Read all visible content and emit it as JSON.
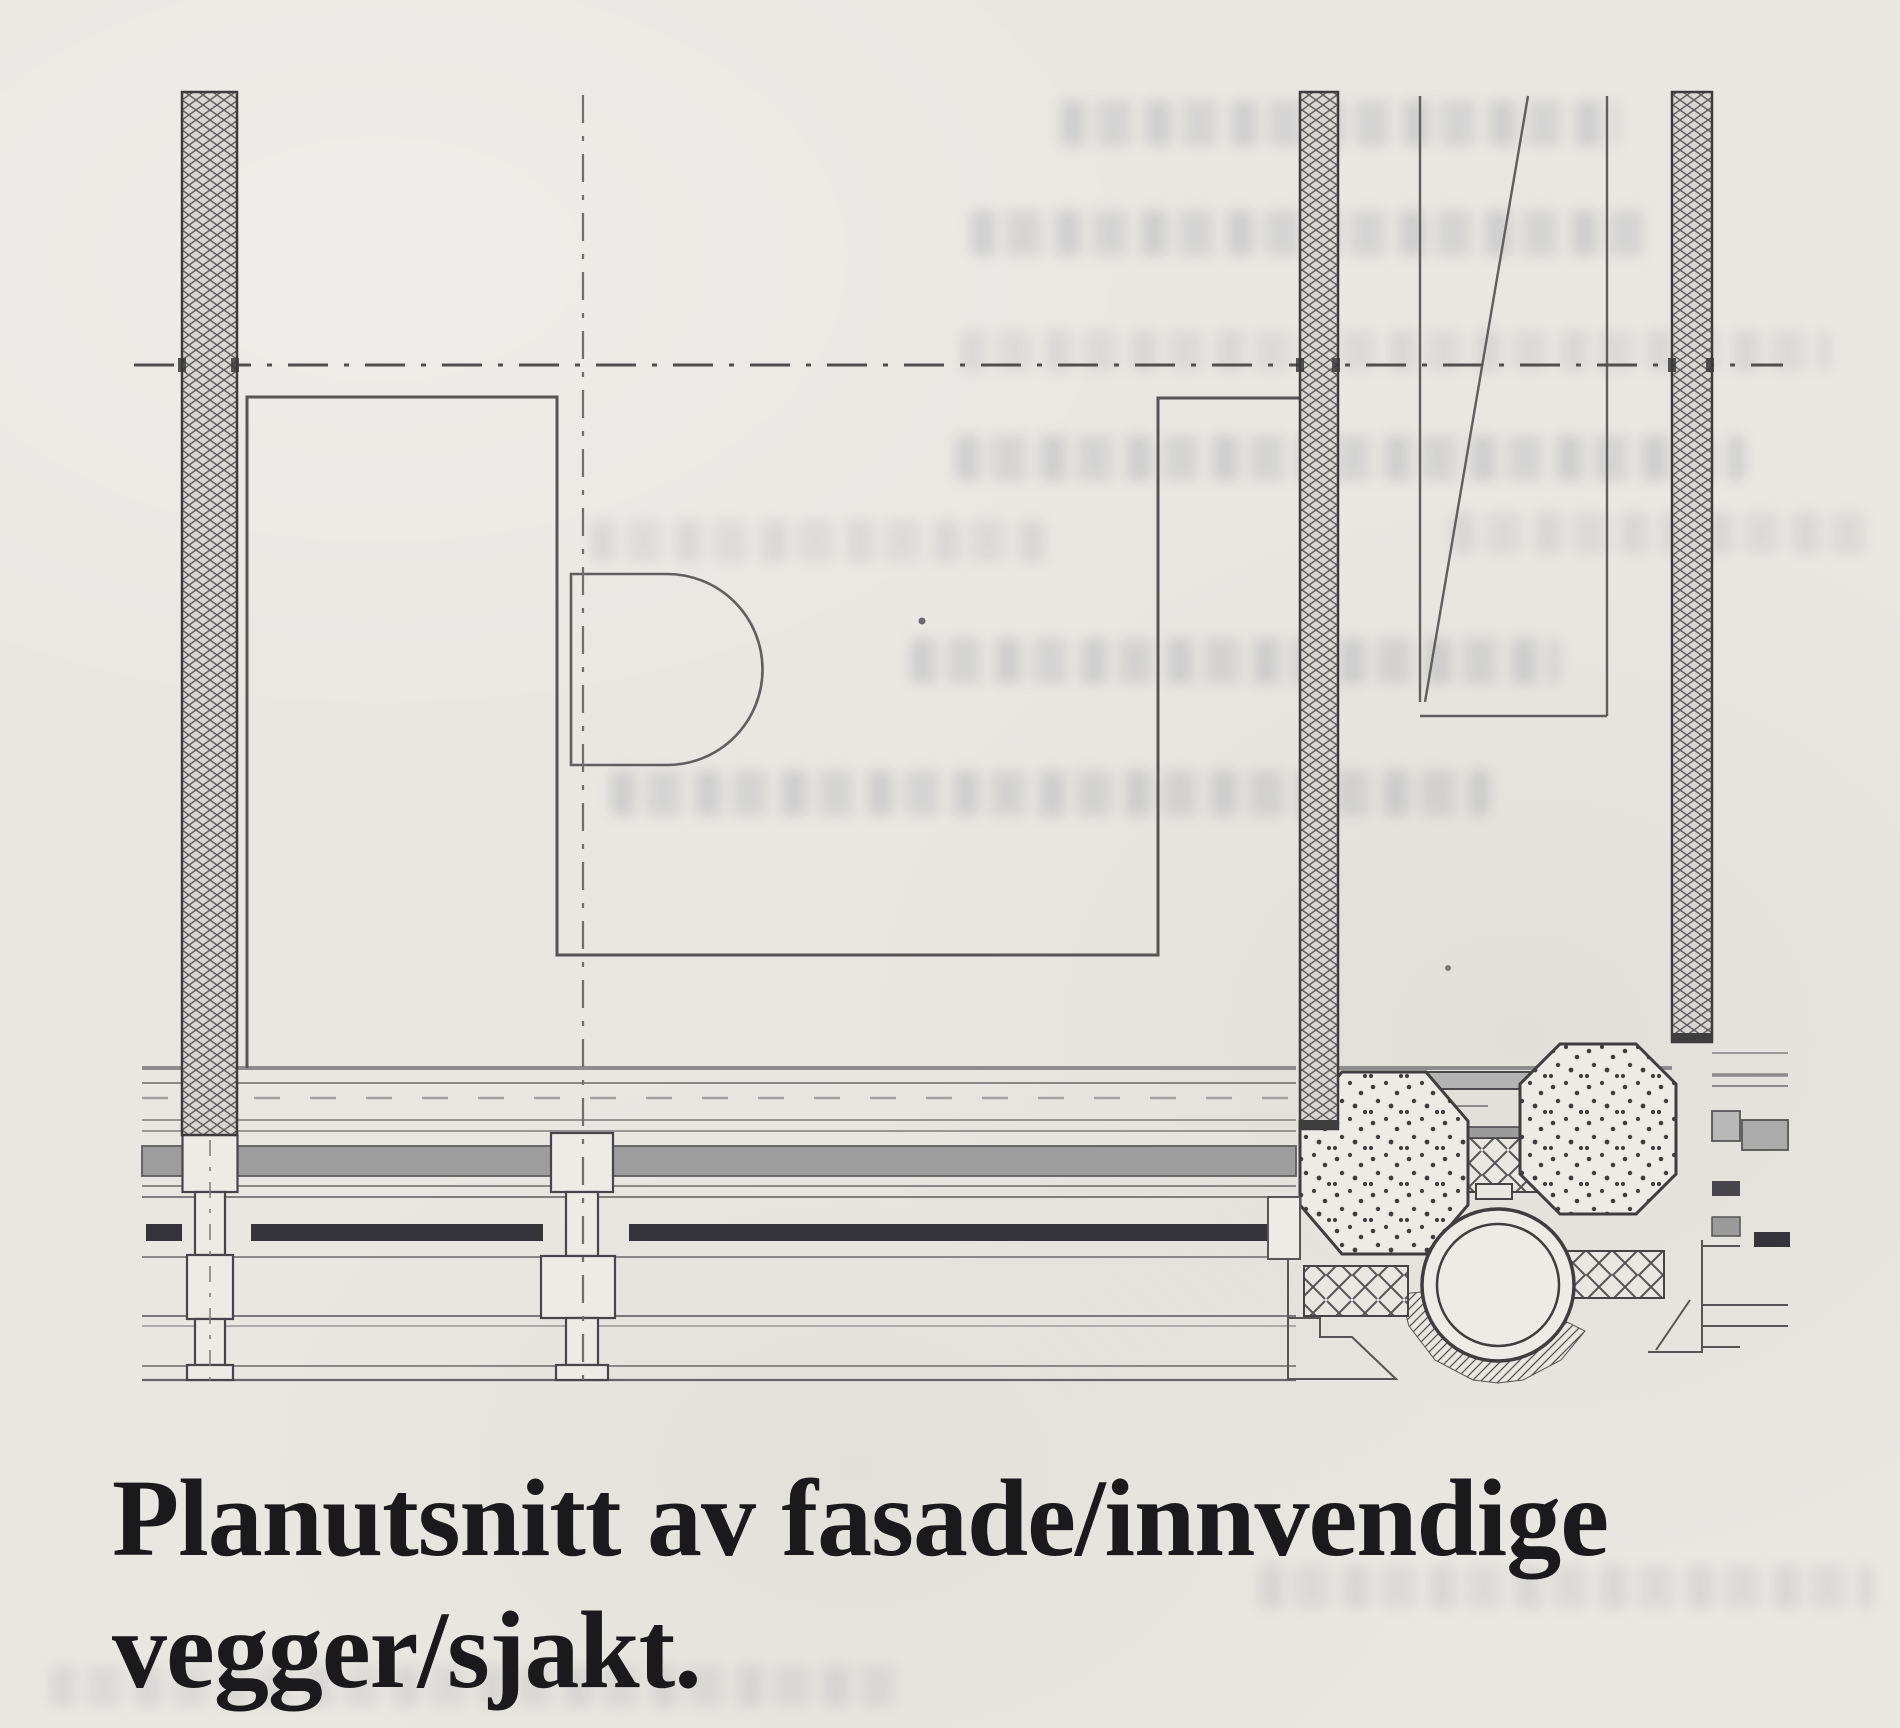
{
  "caption": {
    "line1": "Planutsnitt av fasade/innvendige",
    "line2": "vegger/sjakt."
  },
  "figure": {
    "kind": "architectural plan detail drawing",
    "elements": [
      "exterior facade wall with insulation hatch (left)",
      "interior partition wall with insulation hatch (center)",
      "interior partition wall with insulation hatch (right)",
      "horizontal centerline (dash-dot)",
      "vertical centerline (dash-dot)",
      "interior room outline",
      "door niche (D-shape)",
      "shaft outline with diagonal",
      "facade band with glazing bars and mullions",
      "two stippled concrete columns",
      "round pipe/duct in plan",
      "mineral-wool insulation patches",
      "bleed-through text from reverse page side"
    ]
  },
  "colors": {
    "paper": "#e9e7e2",
    "ink": "#4c4c4c",
    "band_gray": "#9d9d9d",
    "glazing_bar_dark": "#34343a",
    "bleed_tint": "#636b82"
  }
}
